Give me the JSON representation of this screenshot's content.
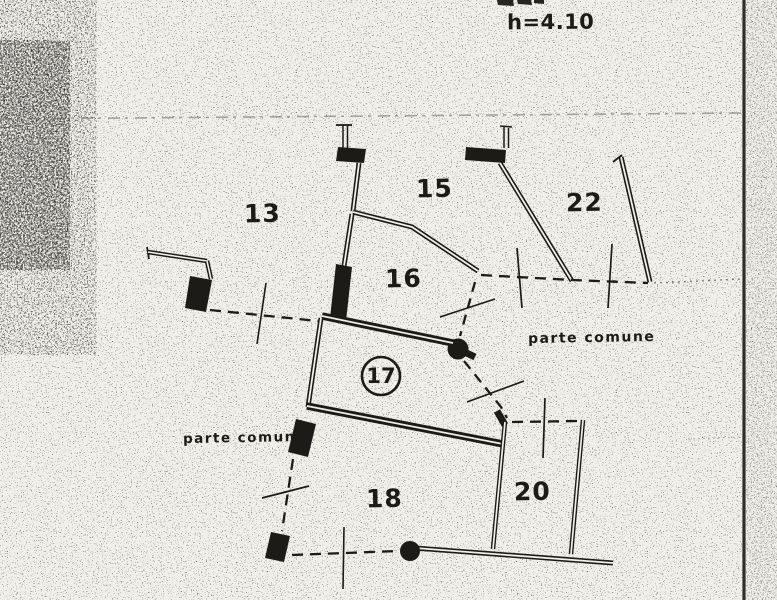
{
  "plan": {
    "height_annotation": "h=4.10",
    "rooms": [
      {
        "number": "13",
        "circled": false
      },
      {
        "number": "15",
        "circled": false
      },
      {
        "number": "16",
        "circled": false
      },
      {
        "number": "17",
        "circled": true
      },
      {
        "number": "18",
        "circled": false
      },
      {
        "number": "20",
        "circled": false
      },
      {
        "number": "22",
        "circled": false
      }
    ],
    "common_area_labels": [
      {
        "text": "parte comune"
      },
      {
        "text": "parte comune"
      }
    ],
    "colors": {
      "ink": "#1c1b18",
      "paper": "#f1efe9"
    }
  }
}
